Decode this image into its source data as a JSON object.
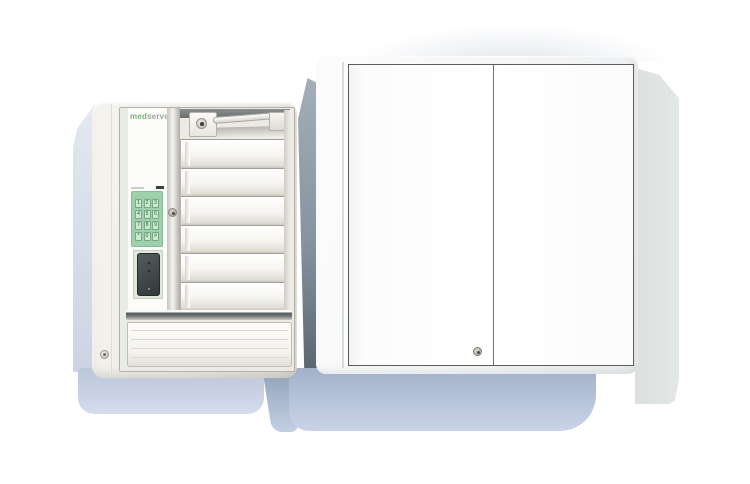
{
  "product_shot": {
    "brand": {
      "text": "medserve",
      "prefix": "med",
      "suffix": "serve"
    },
    "left_unit": {
      "keypad": {
        "keys": [
          "1",
          "2",
          "3",
          "4",
          "5",
          "6",
          "7",
          "8",
          "9",
          "*",
          "0",
          "#"
        ]
      },
      "drawer_count": 6,
      "bottom_drawer_ridge_count": 4,
      "lock_count": 3
    },
    "right_cabinet": {
      "door_count": 2,
      "lock_count": 1
    },
    "palette": {
      "background": "#ffffff",
      "unit_body_cream": "#ebe9e2",
      "keypad_green": "#9ed0ab",
      "keypad_key_green": "#cde8d2",
      "brand_green": "#74b07c",
      "brand_gray": "#9aa59d",
      "socket_dark": "#3a4041",
      "shadow_blue": "#b4c1d8",
      "shadow_slate": "#8793a0",
      "side_panel_shadow": "#dfe3e1",
      "cabinet_white": "#ffffff"
    }
  }
}
